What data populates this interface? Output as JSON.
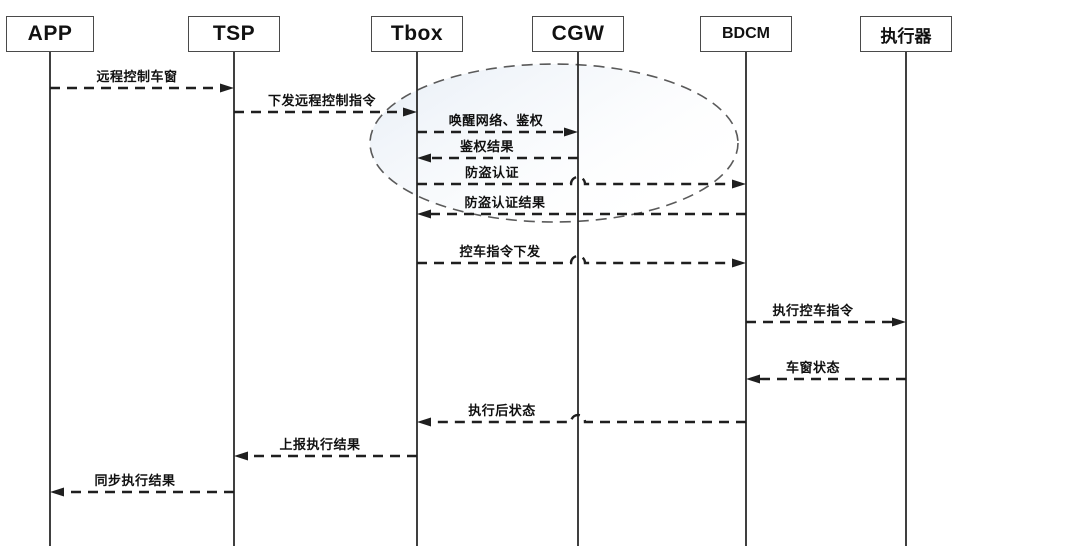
{
  "diagram": {
    "type": "sequence-diagram",
    "subject": "远程控制车窗",
    "colors": {
      "background": "#ffffff",
      "stroke": "#1f1f1f",
      "text": "#111111",
      "box_border": "#4a4a4a",
      "ellipse_stroke": "#5a5a5a",
      "ellipse_fill_start": "#dbe5f1",
      "ellipse_fill_end": "#ffffff"
    }
  },
  "actors": [
    {
      "id": "APP",
      "label": "APP"
    },
    {
      "id": "TSP",
      "label": "TSP"
    },
    {
      "id": "Tbox",
      "label": "Tbox"
    },
    {
      "id": "CGW",
      "label": "CGW"
    },
    {
      "id": "BDCM",
      "label": "BDCM"
    },
    {
      "id": "actuator",
      "label": "执行器"
    }
  ],
  "messages": [
    {
      "from": "APP",
      "to": "TSP",
      "label": "远程控制车窗"
    },
    {
      "from": "TSP",
      "to": "Tbox",
      "label": "下发远程控制指令"
    },
    {
      "from": "Tbox",
      "to": "CGW",
      "label": "唤醒网络、鉴权"
    },
    {
      "from": "CGW",
      "to": "Tbox",
      "label": "鉴权结果"
    },
    {
      "from": "Tbox",
      "to": "BDCM",
      "label": "防盗认证"
    },
    {
      "from": "BDCM",
      "to": "Tbox",
      "label": "防盗认证结果"
    },
    {
      "from": "Tbox",
      "to": "BDCM",
      "label": "控车指令下发"
    },
    {
      "from": "BDCM",
      "to": "actuator",
      "label": "执行控车指令"
    },
    {
      "from": "actuator",
      "to": "BDCM",
      "label": "车窗状态"
    },
    {
      "from": "BDCM",
      "to": "Tbox",
      "label": "执行后状态"
    },
    {
      "from": "Tbox",
      "to": "TSP",
      "label": "上报执行结果"
    },
    {
      "from": "TSP",
      "to": "APP",
      "label": "同步执行结果"
    }
  ],
  "highlight_ellipse": {
    "style": "dashed",
    "encloses_message_indices": [
      2,
      3,
      4,
      5
    ]
  }
}
